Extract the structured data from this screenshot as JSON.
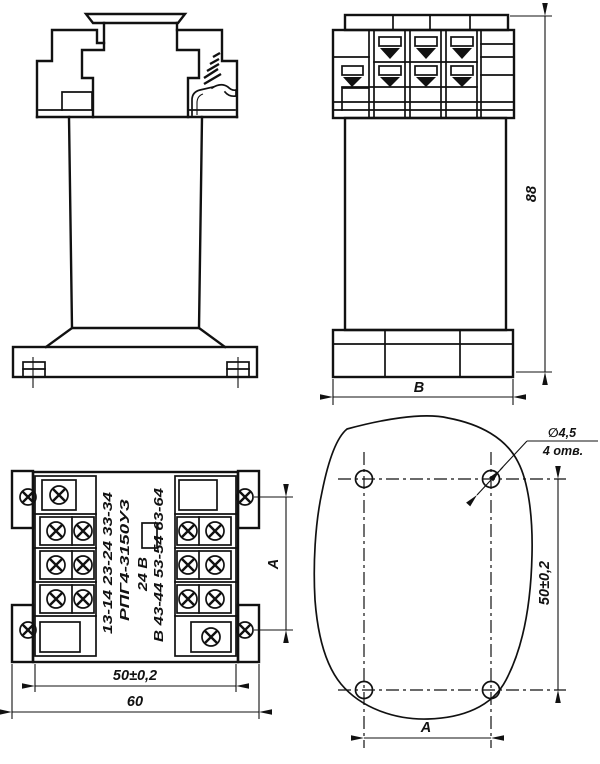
{
  "drawing": {
    "subject": "relay-outline-and-mounting-drawing",
    "colors": {
      "line": "#111111",
      "background": "#ffffff"
    },
    "views": {
      "side": {
        "dim_height": "88",
        "dim_width": "В"
      },
      "bottom": {
        "label_contacts_left": "13-14 23-24 33-34",
        "label_type": "РПГ4-3150УЗ",
        "label_voltage": "24 В",
        "label_contacts_right": "В 43-44 53-54 63-64",
        "dim_hole_spacing": "50±0,2",
        "dim_width": "60",
        "dim_height": "А"
      },
      "template": {
        "callout_diameter": "∅4,5",
        "callout_holes": "4 отв.",
        "dim_vertical": "50±0,2",
        "dim_horizontal": "А"
      }
    }
  }
}
